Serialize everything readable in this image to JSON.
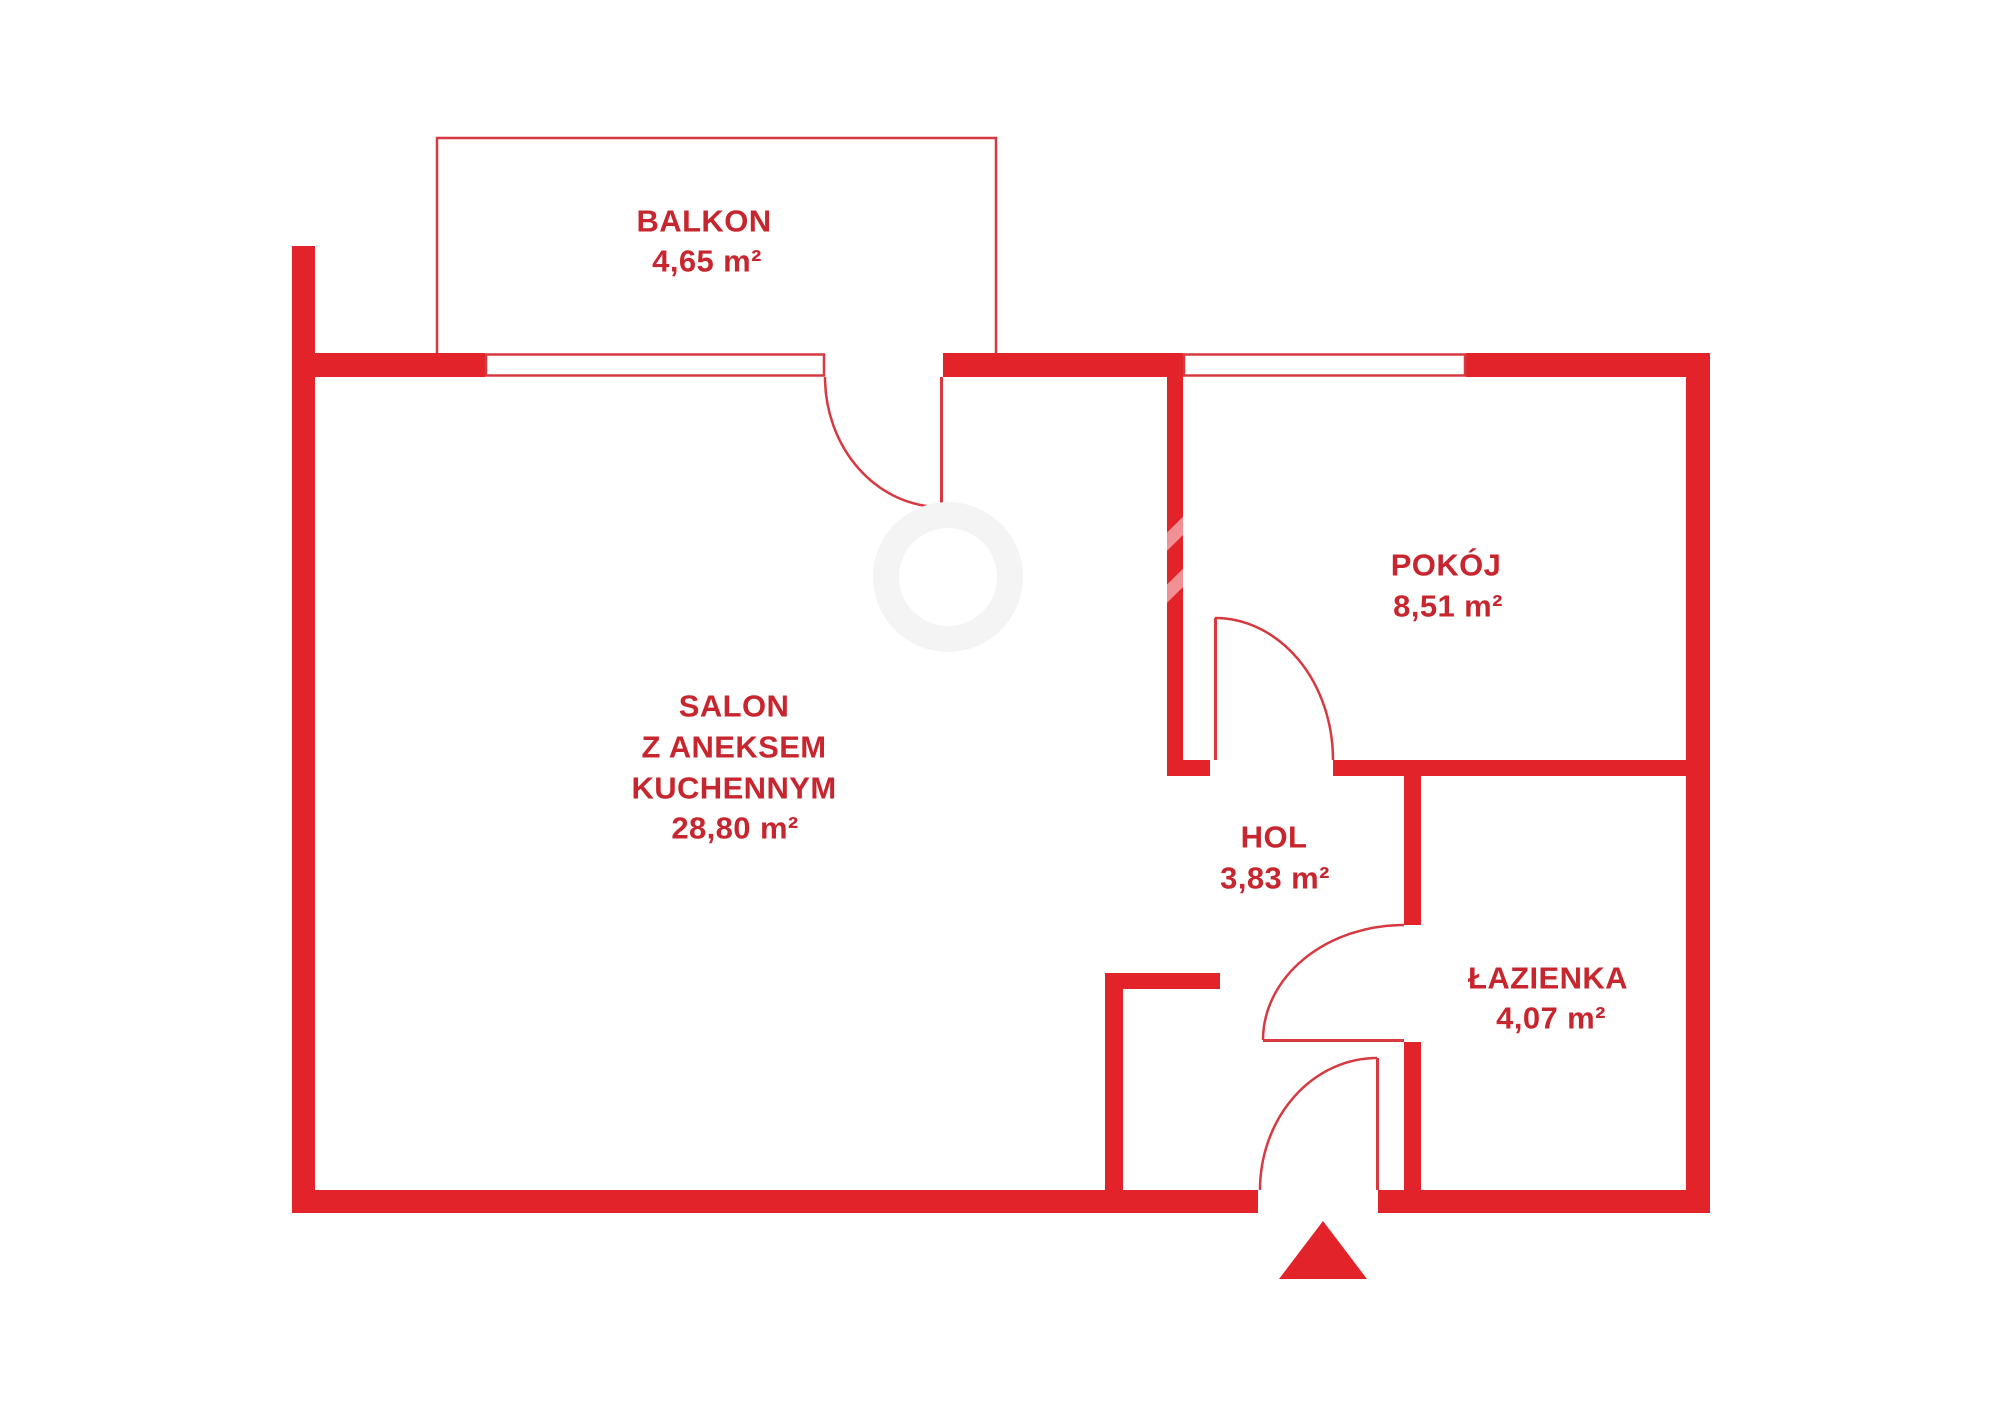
{
  "document": {
    "kind": "apartment floor plan"
  },
  "colors": {
    "wall": "#e2232a",
    "text": "#c7262e",
    "line": "#d63a40",
    "background": "#ffffff"
  },
  "rooms": {
    "balkon": {
      "name": "BALKON",
      "area": "4,65 m²"
    },
    "salon": {
      "name_lines": [
        "SALON",
        "Z ANEKSEM",
        "KUCHENNYM"
      ],
      "area": "28,80 m²"
    },
    "pokoj": {
      "name": "POKÓJ",
      "area": "8,51 m²"
    },
    "hol": {
      "name": "HOL",
      "area": "3,83 m²"
    },
    "lazienka": {
      "name": "ŁAZIENKA",
      "area": "4,07 m²"
    }
  }
}
